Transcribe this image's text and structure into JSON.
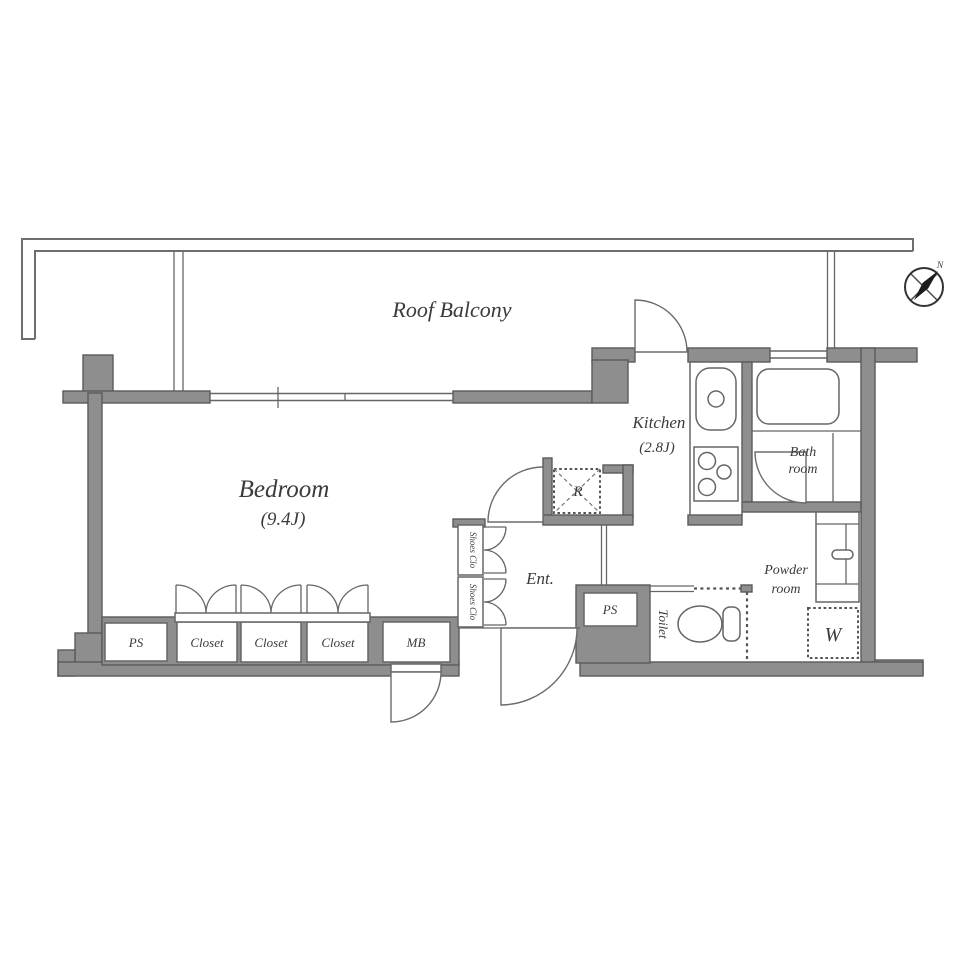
{
  "plan_title": "apartment floor plan",
  "rooms": {
    "roof_balcony": "Roof Balcony",
    "bedroom": {
      "name": "Bedroom",
      "size": "(9.4J)"
    },
    "kitchen": {
      "name": "Kitchen",
      "size": "(2.8J)"
    },
    "bath_room": {
      "line1": "Bath",
      "line2": "room"
    },
    "powder_room": {
      "line1": "Powder",
      "line2": "room"
    },
    "entrance": "Ent.",
    "toilet": "Toilet"
  },
  "features": {
    "closet": "Closet",
    "shoes_closet": "Shoes Clo",
    "meter_box": "MB",
    "pipe_space": "PS",
    "washing_machine": "W",
    "refrigerator": "R"
  },
  "compass": {
    "north": "N"
  },
  "colors": {
    "wall_fill": "#8e8e8e",
    "wall_edge": "#5a5a5a",
    "line": "#666666",
    "text": "#3b3b3b"
  }
}
